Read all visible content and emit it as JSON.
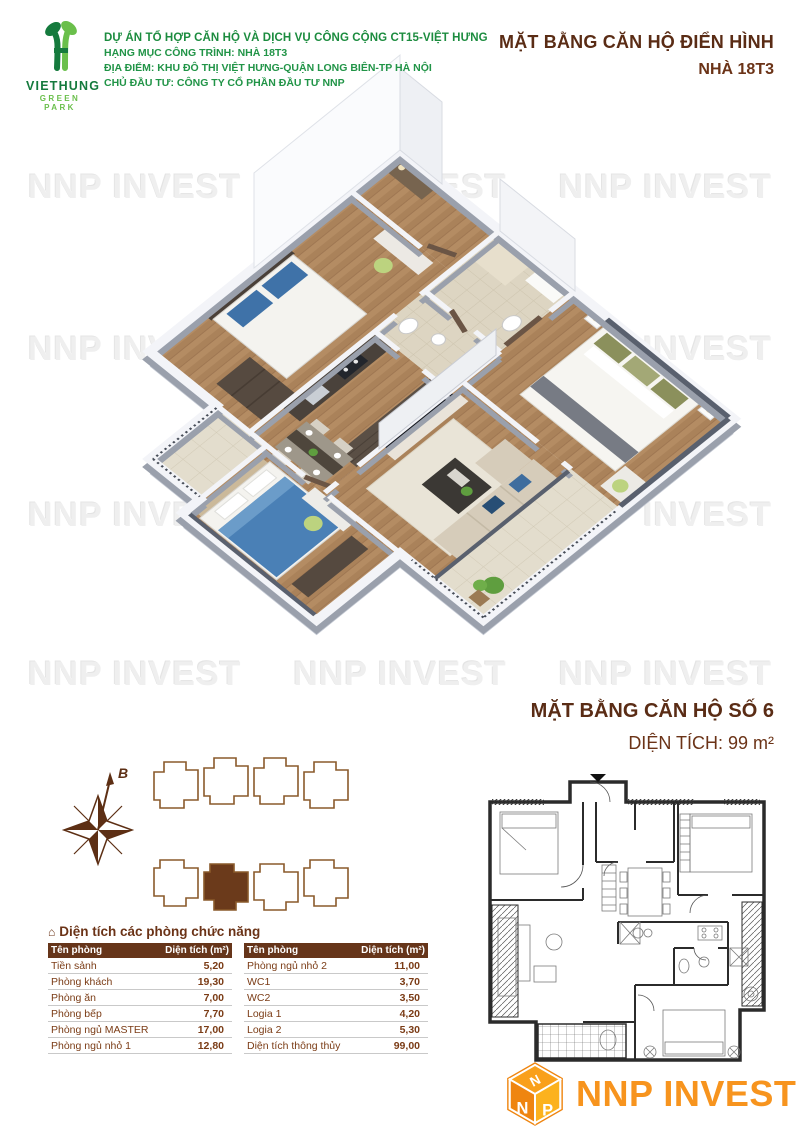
{
  "header": {
    "logo": {
      "brand": "VIETHUNG",
      "tagline": "GREEN PARK"
    },
    "project_lines": [
      "DỰ ÁN TỔ HỢP CĂN HỘ VÀ DỊCH VỤ CÔNG CỘNG CT15-VIỆT HƯNG",
      "HẠNG MỤC CÔNG TRÌNH: NHÀ 18T3",
      "ĐỊA ĐIỂM: KHU ĐÔ THỊ VIỆT HƯNG-QUẬN LONG BIÊN-TP HÀ NỘI",
      "CHỦ ĐẦU TƯ: CÔNG TY CỔ PHẦN ĐẦU TƯ NNP"
    ],
    "title": "MẶT BẰNG CĂN HỘ ĐIỂN HÌNH",
    "subtitle": "NHÀ 18T3"
  },
  "watermark": {
    "text": "NNP INVEST"
  },
  "unit_section": {
    "title": "MẶT BẰNG CĂN HỘ SỐ 6",
    "area_text": "DIỆN TÍCH: 99 m²"
  },
  "keyplan": {
    "compass_label": "B"
  },
  "icons": {
    "house": "⌂"
  },
  "room_table": {
    "title": "Diện tích các phòng chức năng",
    "columns": {
      "name": "Tên phòng",
      "area": "Diện tích (m²)"
    },
    "left_rows": [
      {
        "name": "Tiền sảnh",
        "area": "5,20"
      },
      {
        "name": "Phòng khách",
        "area": "19,30"
      },
      {
        "name": "Phòng ăn",
        "area": "7,00"
      },
      {
        "name": "Phòng bếp",
        "area": "7,70"
      },
      {
        "name": "Phòng ngủ MASTER",
        "area": "17,00"
      },
      {
        "name": "Phòng ngủ nhỏ 1",
        "area": "12,80"
      }
    ],
    "right_rows": [
      {
        "name": "Phòng ngủ nhỏ 2",
        "area": "11,00"
      },
      {
        "name": "WC1",
        "area": "3,70"
      },
      {
        "name": "WC2",
        "area": "3,50"
      },
      {
        "name": "Logia 1",
        "area": "4,20"
      },
      {
        "name": "Logia 2",
        "area": "5,30"
      },
      {
        "name": "Diện tích thông thủy",
        "area": "99,00"
      }
    ]
  },
  "footer_logo": {
    "text": "NNP INVEST",
    "cube": {
      "top": "N",
      "left": "N",
      "right": "P"
    }
  },
  "colors": {
    "green": "#1c8c3f",
    "brown": "#5a2c15",
    "table_header": "#66351a",
    "orange": "#f7941e"
  }
}
